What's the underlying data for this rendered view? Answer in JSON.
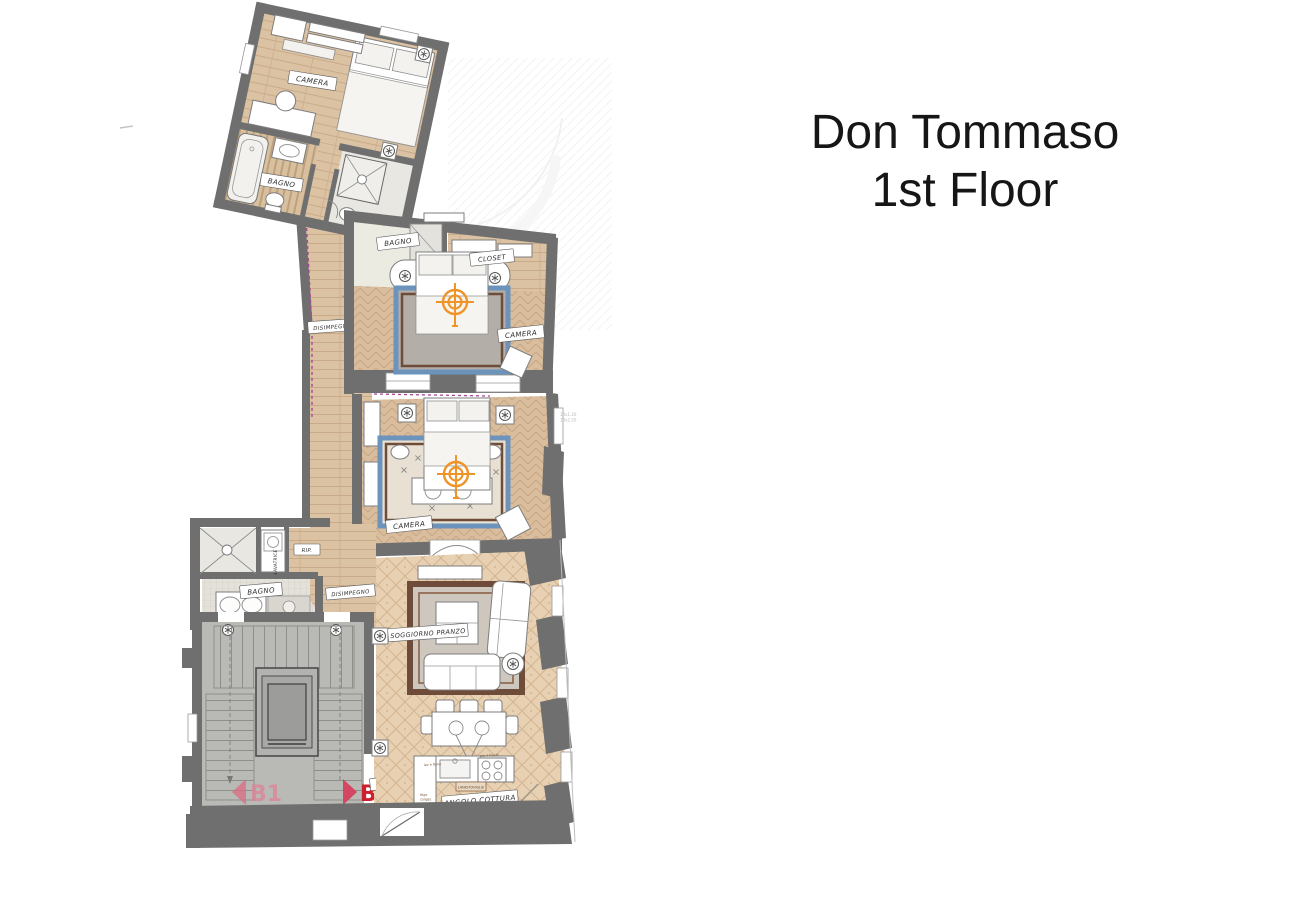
{
  "title": {
    "line1": "Don Tommaso",
    "line2": "1st Floor"
  },
  "plan": {
    "rooms": {
      "camera_top": "CAMERA",
      "bagno_top": "BAGNO",
      "bagno_mid": "BAGNO",
      "closet": "CLOSET",
      "camera_mid": "CAMERA",
      "disimpegno_upper": "DISIMPEGNO",
      "camera_lower": "CAMERA",
      "lavatrice": "LAVATRICE",
      "rip": "RIP.",
      "bagno_lower": "BAGNO",
      "disimpegno_lower": "DISIMPEGNO",
      "soggiorno": "SOGGIORNO PRANZO",
      "ingresso": "INGRESSO",
      "angolo_cottura": "ANGOLO COTTURA"
    },
    "markers": {
      "b1": "B1",
      "b2": "B2"
    },
    "kitchen_notes": {
      "dishwasher": "LAVASTOVIGLIE",
      "hob": "pia 4 fuochi",
      "oven": "lav e forno",
      "fridge_l1": "frigo",
      "fridge_l2": "congel."
    },
    "dim_note": {
      "l1": "14x1.20",
      "l2": "14x2.20"
    },
    "colors": {
      "wall": "#6f6f6f",
      "wood": "#dbc2a3",
      "target_orange": "#ee9428",
      "rug_blue": "#6b93bb",
      "rug_brown": "#6f4b39",
      "b1_pink": "#dd8496",
      "b2_red": "#ce1f2f",
      "stair_gray": "#b9b9b6",
      "magenta_line": "#a8469a"
    }
  }
}
